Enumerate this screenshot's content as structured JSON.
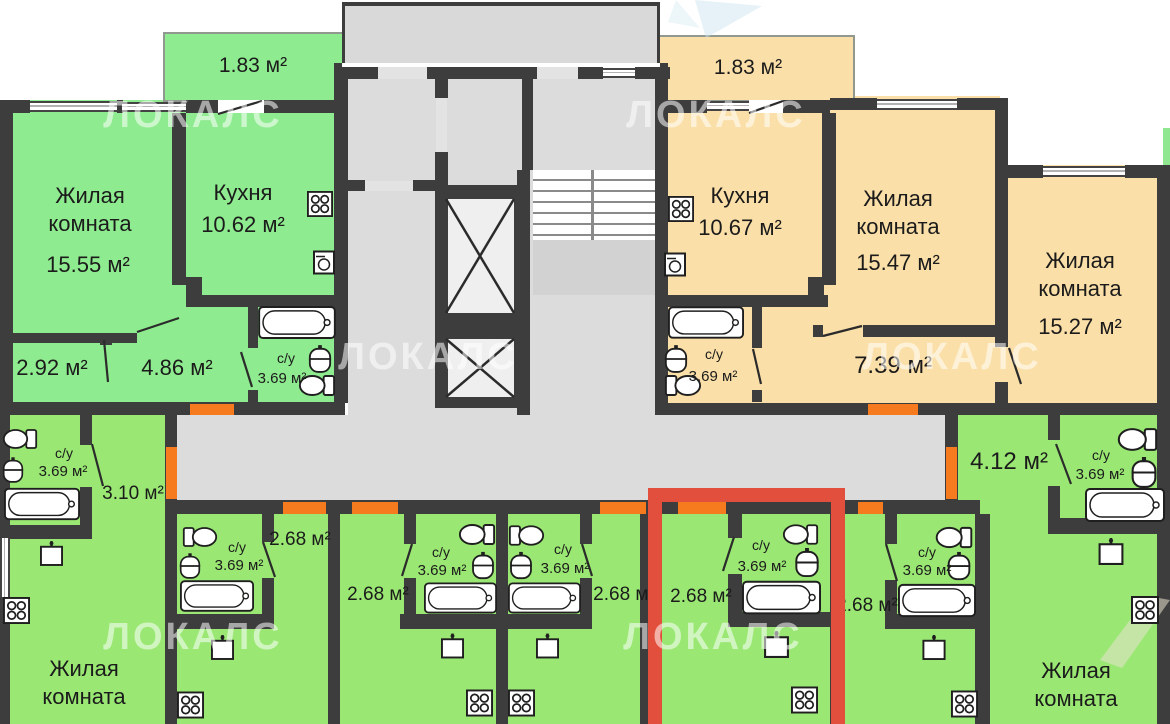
{
  "watermark": "ЛОКАЛС",
  "colors": {
    "wall": "#3d3d3d",
    "left_apartment": "#8feb8f",
    "right_apartment": "#fbdfa8",
    "studio": "#9ae873",
    "common_area": "#dcdcdc",
    "door": "#f57b1e",
    "highlight": "#e2503d"
  },
  "apartments": {
    "left": {
      "balcony_area": "1.83 м²",
      "living_name_1": "Жилая",
      "living_name_2": "комната",
      "living_area": "15.55 м²",
      "kitchen_name": "Кухня",
      "kitchen_area": "10.62 м²",
      "entry_area": "2.92 м²",
      "hall_area": "4.86 м²",
      "bath_name": "с/у",
      "bath_area": "3.69 м²"
    },
    "right": {
      "balcony_area": "1.83 м²",
      "kitchen_name": "Кухня",
      "kitchen_area": "10.67 м²",
      "living1_name_1": "Жилая",
      "living1_name_2": "комната",
      "living1_area": "15.47 м²",
      "living2_name_1": "Жилая",
      "living2_name_2": "комната",
      "living2_area": "15.27 м²",
      "hall_area": "7.39 м²",
      "bath_name": "с/у",
      "bath_area": "3.69 м²"
    }
  },
  "studios": {
    "a": {
      "bath_name": "с/у",
      "bath_area": "3.69 м²",
      "hall_area": "3.10 м²",
      "living_1": "Жилая",
      "living_2": "комната"
    },
    "b": {
      "bath_name": "с/у",
      "bath_area": "3.69 м²",
      "hall_area": "2.68 м²"
    },
    "c": {
      "bath_name": "с/у",
      "bath_area": "3.69 м²",
      "hall_area": "2.68 м²"
    },
    "d": {
      "bath_name": "с/у",
      "bath_area": "3.69 м²",
      "hall_area": "2.68 м²"
    },
    "e": {
      "bath_name": "с/у",
      "bath_area": "3.69 м²",
      "hall_area": "2.68 м²"
    },
    "f": {
      "bath_name": "с/у",
      "bath_area": "3.69 м²",
      "hall_area": "2.68 м²"
    },
    "g": {
      "bath_name": "с/у",
      "bath_area": "3.69 м²",
      "hall_area": "4.12 м²",
      "living_1": "Жилая",
      "living_2": "комната"
    }
  }
}
